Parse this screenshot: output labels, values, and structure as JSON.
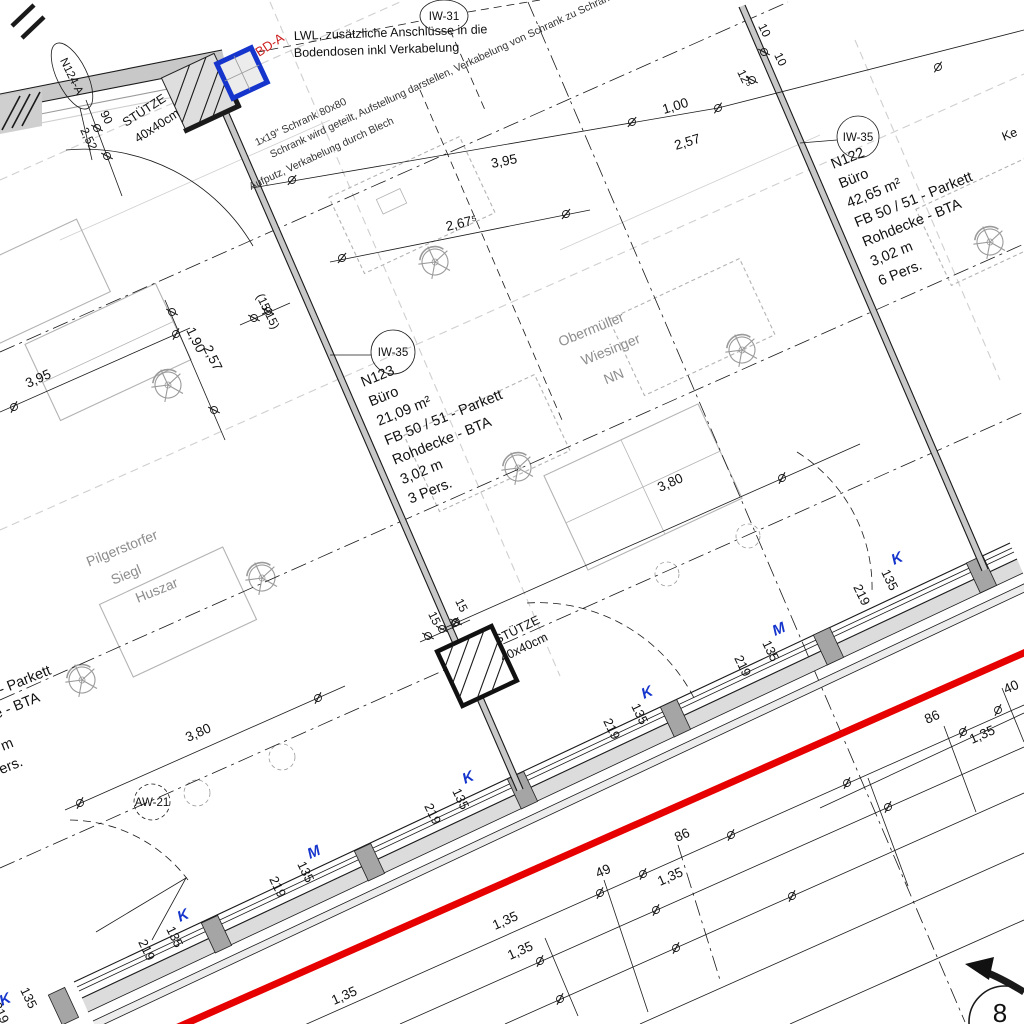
{
  "drawing": {
    "annotations": {
      "lwl": [
        "LWL, zusätzliche Anschlüsse in die",
        "Bodendosen inkl Verkabelung"
      ],
      "bd_a": "BD-A",
      "schrank": [
        "1x19\" Schrank 80x80",
        "Schrank wird geteilt, Aufstellung darstellen, Verkabelung von Schrank zu Schrank",
        "Aufputz, Verkabelung durch Blech"
      ]
    },
    "columns": {
      "label": "STÜTZE",
      "size": "40x40cm"
    },
    "rooms": {
      "n123": {
        "id": "N123",
        "type": "Büro",
        "area": "21,09 m²",
        "floor": "FB 50 / 51 - Parkett",
        "ceiling": "Rohdecke - BTA",
        "height": "3,02 m",
        "persons": "3 Pers."
      },
      "n122": {
        "id": "N122",
        "type": "Büro",
        "area": "42,65 m²",
        "floor": "FB 50 / 51 - Parkett",
        "ceiling": "Rohdecke - BTA",
        "height": "3,02 m",
        "persons": "6 Pers."
      },
      "left": {
        "floor": "FB 50 / 51 - Parkett",
        "ceiling": "Rohdecke - BTA",
        "height": "3,02 m",
        "persons": "3 Pers."
      }
    },
    "occupants": {
      "mid": [
        "Obermüller",
        "Wiesinger",
        "NN"
      ],
      "left": [
        "Pilgerstorfer",
        "Siegl",
        "Huszar"
      ]
    },
    "wall_tags": {
      "iw31": "IW-31",
      "iw35": "IW-35",
      "n124a": "N124-A",
      "aw21": "AW-21",
      "ke": "Ke"
    },
    "section_marker": "8",
    "window_tags": [
      {
        "type": "K",
        "w": "135",
        "h": "219"
      },
      {
        "type": "K",
        "w": "135",
        "h": "219"
      },
      {
        "type": "M",
        "w": "135",
        "h": "219"
      },
      {
        "type": "K",
        "w": "135",
        "h": "219"
      },
      {
        "type": "K",
        "w": "135",
        "h": "219"
      },
      {
        "type": "M",
        "w": "135",
        "h": "219"
      },
      {
        "type": "K",
        "w": "135",
        "h": "219"
      }
    ],
    "dimensions": {
      "top": [
        "3,95",
        "1,00",
        "2,57",
        "2,67⁵"
      ],
      "left": [
        "3,95",
        "1,90",
        "2,57",
        "(15|15)"
      ],
      "column_top": [
        "90",
        "2,52"
      ],
      "column_bottom": [
        "15",
        "15"
      ],
      "wall_right": [
        "12⁵",
        "10",
        "10"
      ],
      "interior": [
        "3,80",
        "3,80"
      ],
      "bottom": [
        "1,35",
        "1,35",
        "49",
        "86",
        "1,35",
        "86",
        "1,35",
        "1,35",
        "40"
      ]
    },
    "colors": {
      "accent_blue": "#1535cc",
      "section_red": "#e60000",
      "bd_red": "#cc2020"
    }
  }
}
